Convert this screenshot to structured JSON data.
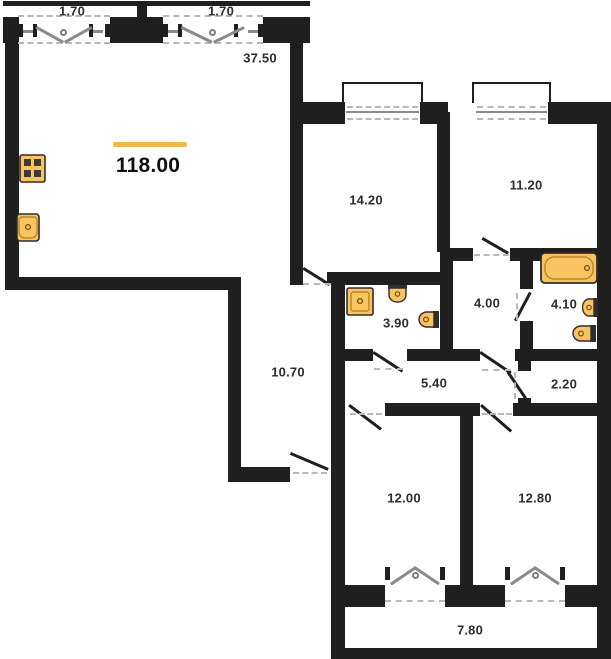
{
  "plan": {
    "total_area": "118.00",
    "labels": {
      "balcony_top_left": "1.70",
      "balcony_top_right": "1.70",
      "living_kitchen": "37.50",
      "bedroom_top_left": "14.20",
      "bedroom_top_right": "11.20",
      "bathroom_small": "3.90",
      "hall": "4.00",
      "bathroom_large": "4.10",
      "corridor": "10.70",
      "hallway": "5.40",
      "storage": "2.20",
      "bedroom_bottom_left": "12.00",
      "bedroom_bottom_right": "12.80",
      "balcony_bottom": "7.80"
    },
    "colors": {
      "accent": "#EDB84E",
      "wall": "#1F1F1F",
      "fixture_fill": "#F9C35F",
      "fixture_stroke": "#2E2E2E",
      "label_text": "#2D2D2D"
    },
    "fixtures": {
      "kitchen": [
        "stove-icon",
        "sink-icon"
      ],
      "bathroom_small": [
        "shower-tray-icon",
        "washbasin-icon",
        "toilet-icon"
      ],
      "bathroom_large": [
        "bathtub-icon",
        "washbasin-icon",
        "toilet-icon"
      ]
    }
  }
}
